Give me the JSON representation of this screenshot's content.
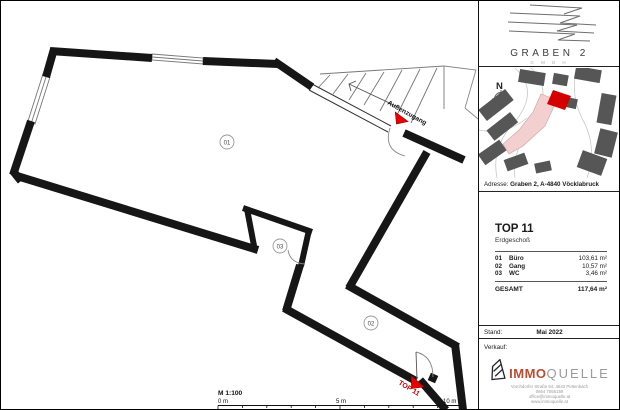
{
  "floorplan": {
    "rooms": [
      {
        "label": "01"
      },
      {
        "label": "03"
      },
      {
        "label": "02"
      }
    ],
    "stairs_label": "Außenzugang",
    "entry_label": "TOP 11",
    "scale": {
      "label": "M 1:100",
      "t0": "0 m",
      "t5": "5 m",
      "t10": "10 m"
    }
  },
  "sidebar": {
    "logo": {
      "title": "GRABEN 2",
      "subtitle": "G M B H"
    },
    "map": {
      "compass": "N"
    },
    "address": {
      "label": "Adresse:",
      "value": "Graben 2, A-4840 Vöcklabruck"
    },
    "unit": {
      "title": "TOP 11",
      "floor": "Erdgeschoß",
      "rooms": [
        {
          "no": "01",
          "name": "Büro",
          "area": "103,61 m²"
        },
        {
          "no": "02",
          "name": "Gang",
          "area": "10,57 m²"
        },
        {
          "no": "03",
          "name": "WC",
          "area": "3,46 m²"
        }
      ],
      "total_label": "GESAMT",
      "total_area": "117,64 m²"
    },
    "stand": {
      "label": "Stand:",
      "value": "Mai 2022"
    },
    "verkauf_label": "Verkauf:",
    "agency": {
      "brand_immo": "IMMO",
      "brand_quelle": "QUELLE",
      "address": "Vorchdorfer Straße 64, 4643 Pettenbach",
      "phone": "0664 7056159",
      "email": "office@immoquelle.at",
      "web": "www.immoquelle.at"
    }
  },
  "colors": {
    "wall": "#161616",
    "accent_red": "#e60000",
    "label_red": "#cc0000",
    "brand_red": "#bf4a2f"
  }
}
